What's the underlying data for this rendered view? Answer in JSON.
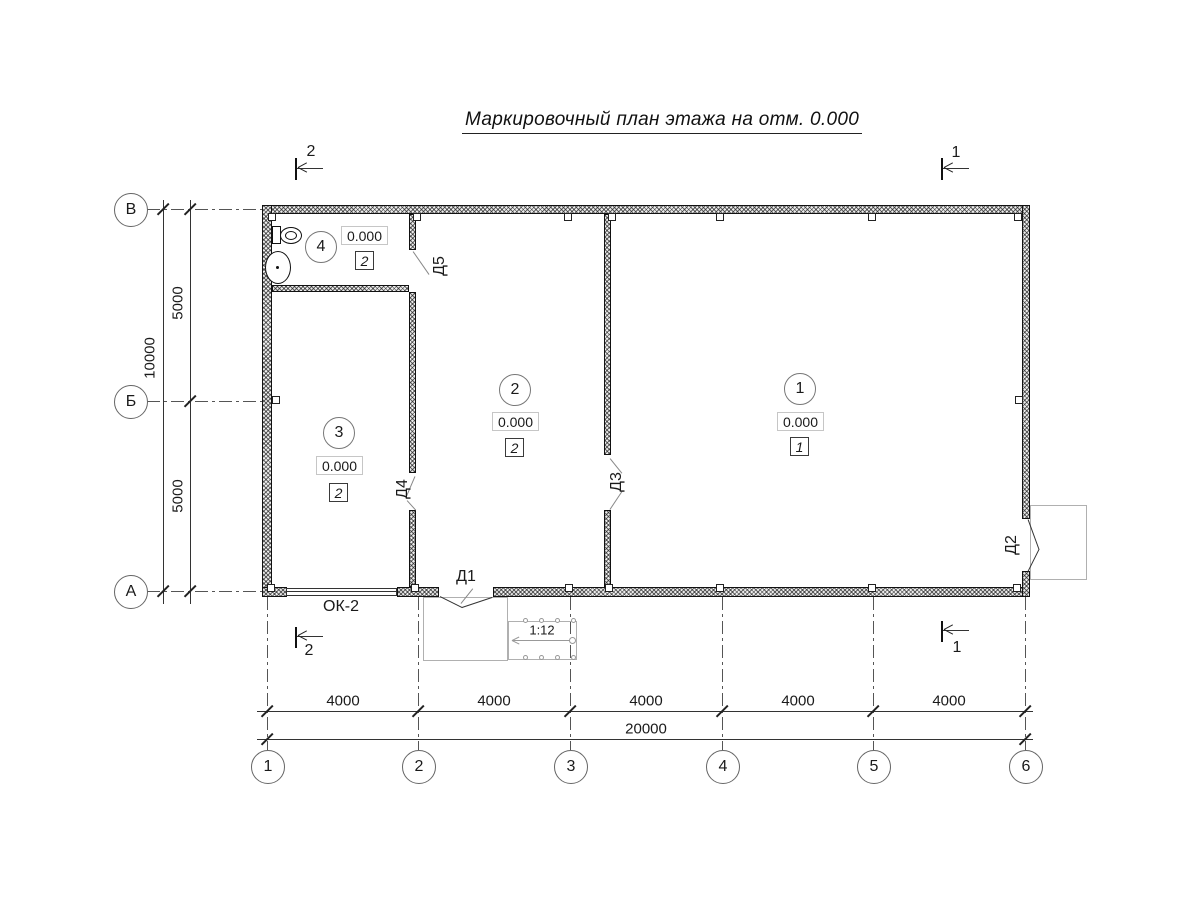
{
  "title": "Маркировочный план этажа на отм. 0.000",
  "axes": {
    "rows": [
      "В",
      "Б",
      "А"
    ],
    "cols": [
      "1",
      "2",
      "3",
      "4",
      "5",
      "6"
    ]
  },
  "dimensions": {
    "vertical": {
      "segments": [
        "5000",
        "5000"
      ],
      "total": "10000"
    },
    "horizontal": {
      "segments": [
        "4000",
        "4000",
        "4000",
        "4000",
        "4000"
      ],
      "total": "20000"
    }
  },
  "rooms": [
    {
      "number": "1",
      "elevation": "0.000",
      "mark": "1"
    },
    {
      "number": "2",
      "elevation": "0.000",
      "mark": "2"
    },
    {
      "number": "3",
      "elevation": "0.000",
      "mark": "2"
    },
    {
      "number": "4",
      "elevation": "0.000",
      "mark": "2"
    }
  ],
  "doors": {
    "d1": "Д1",
    "d2": "Д2",
    "d3": "Д3",
    "d4": "Д4",
    "d5": "Д5"
  },
  "window_label": "ОК-2",
  "ramp": {
    "slope": "1:12"
  },
  "sections": {
    "s1": "1",
    "s2": "2"
  },
  "colors": {
    "line": "#333333",
    "wall_fill": "#ededed",
    "secondary": "#b0b0b0"
  }
}
